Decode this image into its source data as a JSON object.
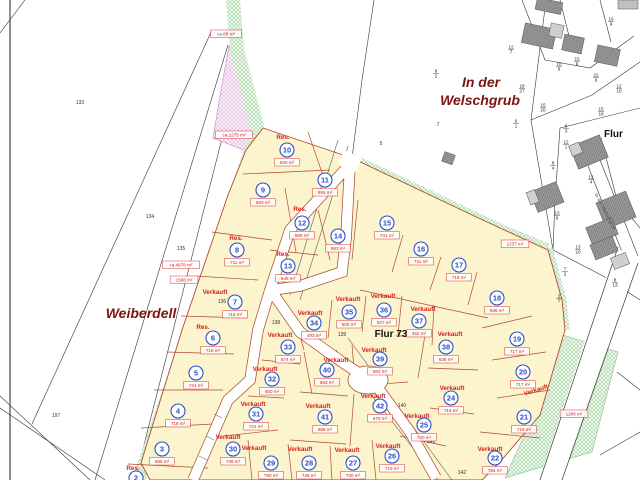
{
  "map": {
    "labels": {
      "weiberdell": "Weiberdell",
      "in_der": "In der",
      "welschgrub": "Welschgrub",
      "flur73": "Flur 73",
      "flur_right": "Flur",
      "street_name": "In der Welschgrub"
    },
    "status_colors": {
      "sold": "#d42020",
      "reserved": "#b22222",
      "plot_circle": "#2b4fc9",
      "area_label": "#c41f1f"
    },
    "fill_colors": {
      "development": "#fbf4cc",
      "green_strip": "#edf7ea",
      "pink_area": "#faf0fa"
    },
    "plots": [
      {
        "n": "2",
        "x": 136,
        "y": 478,
        "area": null,
        "status": "Res.",
        "sx": 133,
        "sy": 468
      },
      {
        "n": "3",
        "x": 162,
        "y": 449,
        "area": "686 m²"
      },
      {
        "n": "4",
        "x": 178,
        "y": 411,
        "area": "718 m²"
      },
      {
        "n": "5",
        "x": 196,
        "y": 373,
        "area": "741 m²"
      },
      {
        "n": "6",
        "x": 213,
        "y": 338,
        "area": "718 m²",
        "status": "Res.",
        "sx": 203,
        "sy": 327
      },
      {
        "n": "7",
        "x": 235,
        "y": 302,
        "area": "716 m²",
        "status": "Verkauft",
        "sx": 215,
        "sy": 292
      },
      {
        "n": "8",
        "x": 237,
        "y": 250,
        "area": "711 m²",
        "status": "Res.",
        "sx": 236,
        "sy": 238
      },
      {
        "n": "9",
        "x": 263,
        "y": 190,
        "area": "583 m²"
      },
      {
        "n": "10",
        "x": 287,
        "y": 150,
        "area": "626 m²",
        "status": "Res.",
        "sx": 283,
        "sy": 137
      },
      {
        "n": "11",
        "x": 325,
        "y": 180,
        "area": "655 m²"
      },
      {
        "n": "12",
        "x": 302,
        "y": 223,
        "area": "656 m²",
        "status": "Res.",
        "sx": 300,
        "sy": 209
      },
      {
        "n": "13",
        "x": 288,
        "y": 266,
        "area": "648 m²",
        "status": "Res.",
        "sx": 283,
        "sy": 254
      },
      {
        "n": "14",
        "x": 338,
        "y": 236,
        "area": "683 m²"
      },
      {
        "n": "15",
        "x": 387,
        "y": 223,
        "area": "741 m²"
      },
      {
        "n": "16",
        "x": 421,
        "y": 249,
        "area": "711 m²"
      },
      {
        "n": "17",
        "x": 459,
        "y": 265,
        "area": "718 m²"
      },
      {
        "n": "18",
        "x": 497,
        "y": 298,
        "area": "836 m²"
      },
      {
        "n": "19",
        "x": 517,
        "y": 339,
        "area": "717 m²"
      },
      {
        "n": "20",
        "x": 523,
        "y": 372,
        "area": "717 m²"
      },
      {
        "n": "21",
        "x": 524,
        "y": 417,
        "area": "718 m²",
        "status": "Verkauft",
        "sx": 536,
        "sy": 390,
        "srot": -18
      },
      {
        "n": "22",
        "x": 495,
        "y": 458,
        "area": "784 m²",
        "status": "Verkauft",
        "sx": 490,
        "sy": 449
      },
      {
        "n": "24",
        "x": 451,
        "y": 398,
        "area": "714 m²",
        "status": "Verkauft",
        "sx": 452,
        "sy": 388
      },
      {
        "n": "25",
        "x": 424,
        "y": 425,
        "area": "720 m²",
        "status": "Verkauft",
        "sx": 417,
        "sy": 416
      },
      {
        "n": "26",
        "x": 392,
        "y": 456,
        "area": "719 m²",
        "status": "Verkauft",
        "sx": 388,
        "sy": 446
      },
      {
        "n": "27",
        "x": 353,
        "y": 463,
        "area": "730 m²",
        "status": "Verkauft",
        "sx": 347,
        "sy": 450
      },
      {
        "n": "28",
        "x": 309,
        "y": 463,
        "area": "736 m²",
        "status": "Verkauft",
        "sx": 300,
        "sy": 449
      },
      {
        "n": "29",
        "x": 271,
        "y": 463,
        "area": "790 m²",
        "status": "Verkauft",
        "sx": 254,
        "sy": 448
      },
      {
        "n": "30",
        "x": 233,
        "y": 449,
        "area": "736 m²",
        "status": "Verkauft",
        "sx": 228,
        "sy": 437
      },
      {
        "n": "31",
        "x": 256,
        "y": 414,
        "area": "721 m²",
        "status": "Verkauft",
        "sx": 253,
        "sy": 404
      },
      {
        "n": "32",
        "x": 272,
        "y": 379,
        "area": "650 m²",
        "status": "Verkauft",
        "sx": 265,
        "sy": 369
      },
      {
        "n": "33",
        "x": 288,
        "y": 347,
        "area": "574 m²",
        "status": "Verkauft",
        "sx": 280,
        "sy": 335
      },
      {
        "n": "34",
        "x": 314,
        "y": 323,
        "area": "493 m²",
        "status": "Verkauft",
        "sx": 310,
        "sy": 313
      },
      {
        "n": "35",
        "x": 349,
        "y": 312,
        "area": "505 m²",
        "status": "Verkauft",
        "sx": 348,
        "sy": 299
      },
      {
        "n": "36",
        "x": 384,
        "y": 310,
        "area": "527 m²",
        "status": "Verkauft",
        "sx": 383,
        "sy": 296
      },
      {
        "n": "37",
        "x": 419,
        "y": 321,
        "area": "492 m²",
        "status": "Verkauft",
        "sx": 423,
        "sy": 309
      },
      {
        "n": "38",
        "x": 446,
        "y": 347,
        "area": "636 m²",
        "status": "Verkauft",
        "sx": 450,
        "sy": 334
      },
      {
        "n": "39",
        "x": 380,
        "y": 359,
        "area": "582 m²",
        "status": "Verkauft",
        "sx": 374,
        "sy": 350
      },
      {
        "n": "40",
        "x": 327,
        "y": 370,
        "area": "563 m²",
        "status": "Verkauft",
        "sx": 336,
        "sy": 360
      },
      {
        "n": "41",
        "x": 325,
        "y": 417,
        "area": "888 m²",
        "status": "Verkauft",
        "sx": 318,
        "sy": 406
      },
      {
        "n": "42",
        "x": 380,
        "y": 406,
        "area": "679 m²",
        "status": "Verkauft",
        "sx": 373,
        "sy": 396
      }
    ],
    "area_boxes": [
      {
        "t": "ca.88 m²",
        "x": 226,
        "y": 34
      },
      {
        "t": "ca.1275 m²",
        "x": 234,
        "y": 135
      },
      {
        "t": "ca.4878 m²",
        "x": 181,
        "y": 265
      },
      {
        "t": "1586 m²",
        "x": 184,
        "y": 280
      },
      {
        "t": "1237 m²",
        "x": 515,
        "y": 244
      },
      {
        "t": "1286 m²",
        "x": 574,
        "y": 414
      }
    ],
    "boundary_points": [
      {
        "t": "133",
        "x": 80,
        "y": 104
      },
      {
        "t": "134",
        "x": 150,
        "y": 218
      },
      {
        "t": "135",
        "x": 181,
        "y": 250
      },
      {
        "t": "197",
        "x": 56,
        "y": 417
      },
      {
        "t": "136",
        "x": 222,
        "y": 303
      },
      {
        "t": "138",
        "x": 276,
        "y": 324
      },
      {
        "t": "139",
        "x": 342,
        "y": 336
      },
      {
        "t": "140",
        "x": 402,
        "y": 407
      },
      {
        "t": "141",
        "x": 431,
        "y": 443
      },
      {
        "t": "142",
        "x": 462,
        "y": 474
      },
      {
        "t": "7",
        "x": 438,
        "y": 126
      },
      {
        "t": "5",
        "x": 381,
        "y": 145
      }
    ],
    "parcel_fractions": [
      {
        "t": "8/2",
        "x": 436,
        "y": 73
      },
      {
        "t": "12/7",
        "x": 511,
        "y": 49
      },
      {
        "t": "18/8",
        "x": 559,
        "y": 66
      },
      {
        "t": "15/8",
        "x": 577,
        "y": 61
      },
      {
        "t": "22/9",
        "x": 596,
        "y": 77
      },
      {
        "t": "12/10",
        "x": 619,
        "y": 88
      },
      {
        "t": "18/27",
        "x": 522,
        "y": 88
      },
      {
        "t": "16/9",
        "x": 611,
        "y": 21
      },
      {
        "t": "15/18",
        "x": 601,
        "y": 111
      },
      {
        "t": "15/20",
        "x": 543,
        "y": 107
      },
      {
        "t": "6/1",
        "x": 516,
        "y": 123
      },
      {
        "t": "8/3",
        "x": 566,
        "y": 128
      },
      {
        "t": "12/1",
        "x": 566,
        "y": 144
      },
      {
        "t": "8/4",
        "x": 553,
        "y": 165
      },
      {
        "t": "12/4",
        "x": 591,
        "y": 179
      },
      {
        "t": "13/9",
        "x": 557,
        "y": 215
      },
      {
        "t": "13/10",
        "x": 578,
        "y": 249
      },
      {
        "t": "7/2",
        "x": 565,
        "y": 271
      },
      {
        "t": "8/13",
        "x": 615,
        "y": 282
      },
      {
        "t": "2/7",
        "x": 559,
        "y": 298
      }
    ]
  }
}
